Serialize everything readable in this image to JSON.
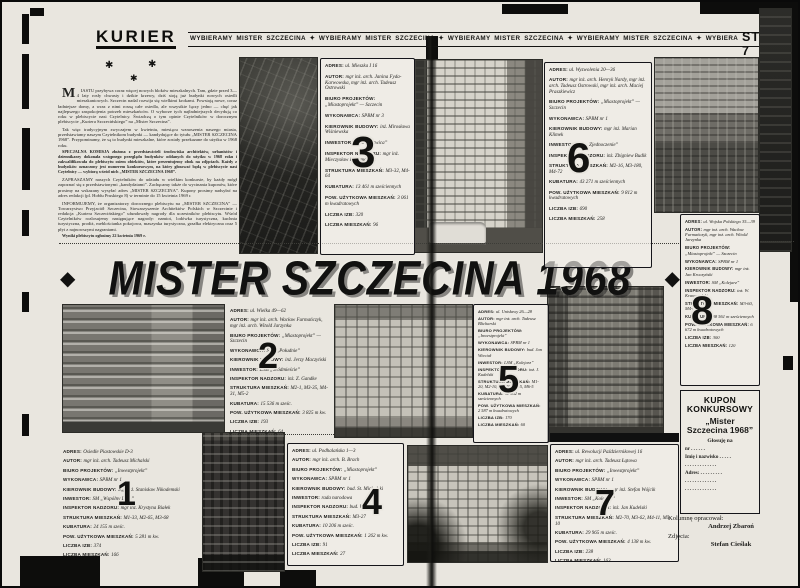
{
  "header": {
    "masthead": "KURIER",
    "slogan": "WYBIERAMY MISTER SZCZECINA ✦ WYBIERAMY MISTER SZCZECINA ✦ WYBIERAMY MISTER SZCZECINA ✦ WYBIERAMY MISTER SZCZECINA ✦ WYBIERAMY MISTER SZCZECINA ✦ WYBIERAMY MISTER",
    "page_number": "STR. 6-7"
  },
  "title": {
    "text": "MISTER SZCZECINA 1968",
    "left_diamond": "◆",
    "right_diamond": "◆"
  },
  "decor": {
    "stars": [
      "✱",
      "✱",
      "✱"
    ]
  },
  "intro": {
    "paragraphs": [
      {
        "drop": "M",
        "bold": false,
        "text": "IASTU przybywa coraz więcej nowych bloków mieszkalnych. Tam, gdzie przed 3—4 laty rosły chwasty i dzikie krzewy, dziś stoją już budynki nowych osiedli mieszkaniowych. Szczecin nadal rozwija się wielkimi krokami. Powstają nowe, coraz ładniejsze domy, a wraz z nimi rosną całe osiedla, ale wszystkie łączy jedno — chęć jak najlepszego zaspokojenia potrzeb mieszkańców. O wyborze tych najładniejszych decydują co roku w plebiscycie nasi Czytelnicy. Świadczą o tym opinie Czytelników w dorocznym plebiscycie „Kuriera Szczecińskiego” na „Mister Szczecina”."
      },
      {
        "bold": false,
        "text": "Tak więc tradycyjnym zwyczajem w kwietniu, miesiącu wznoszenia naszego miasta, przedstawiamy naszym Czytelnikom budynki — kandydujące do tytułu „MISTER SZCZECINA 1968”. Przypominamy, że są to budynki mieszkalne, które zostały przekazane do użytku w 1968 roku."
      },
      {
        "bold": true,
        "text": "SPECJALNA KOMISJA złożona z przedstawicieli środowiska architektów, urbanistów i dziennikarzy dokonała wstępnego przeglądu budynków oddanych do użytku w 1968 roku i zakwalifikowała do plebiscytu osiem obiektów, które prezentujemy obok na zdjęciach. Każdy z budynków oznaczony jest numerem konkursowym, na który głosować będą w plebiscycie nasi Czytelnicy — wybiorą wśród nich „MISTER SZCZECINA 1968”."
      },
      {
        "bold": false,
        "text": "ZAPRASZAMY naszych Czytelników do udziału w wielkim konkursie, by każdy mógł zapoznać się z przedstawionymi „kandydatami”. Zachęcamy także do wycinania kuponów, które prosimy na wskazany wysyłać adres „MISTER SZCZECINA”. Kupony prosimy nadsyłać na adres redakcji (pl. Hołdu Pruskiego 8) w terminie do 15 kwietnia 1969 r."
      },
      {
        "bold": false,
        "text": "INFORMUJEMY, że organizatorzy dorocznego plebiscytu na „MISTER SZCZECINA” — Towarzystwo Przyjaciół Szczecina, Stowarzyszenie Architektów Polskich w Szczecinie i redakcja „Kuriera Szczecińskiego” ufundowały nagrody dla uczestników plebiscytu. Wśród Czytelników rozlosujemy następujące nagrody: namiot, lodówka turystyczna, kuchnia turystyczna, prodiż, meblościanka pokojowa, maszynka turystyczna, grzałka elektryczna oraz 5 płyt z najnowszymi nagraniami."
      },
      {
        "bold": true,
        "text": "Wyniki plebiscytu ogłosimy 22 kwietnia 1969 r."
      }
    ]
  },
  "blocks": [
    {
      "number": "1",
      "lines": [
        {
          "label": "ADRES:",
          "text": "Osiedle Piastowskie D-3"
        },
        {
          "label": "AUTOR:",
          "text": "mgr inż. arch. Tadeusz Michalski"
        },
        {
          "label": "BIURO PROJEKTÓW:",
          "text": "„Inwestprojekt”"
        },
        {
          "label": "WYKONAWCA:",
          "text": "SPBM nr 1"
        },
        {
          "label": "KIEROWNIK BUDOWY:",
          "text": "mgr inż. Stanisław Nikodemski"
        },
        {
          "label": "INWESTOR:",
          "text": "SM „Wspólny Dom”"
        },
        {
          "label": "INSPEKTOR NADZORU:",
          "text": "mgr inż. Krystyna Białek"
        },
        {
          "label": "STRUKTURA MIESZKAŃ:",
          "text": "M1-33, M2-65, M3-68"
        },
        {
          "label": "KUBATURA:",
          "text": "24 155 m sześc."
        },
        {
          "label": "POW. UŻYTKOWA MIESZKAŃ:",
          "text": "5 281 m kw."
        },
        {
          "label": "LICZBA IZB:",
          "text": "374"
        },
        {
          "label": "LICZBA MIESZKAŃ:",
          "text": "166"
        }
      ]
    },
    {
      "number": "2",
      "lines": [
        {
          "label": "ADRES:",
          "text": "ul. Wielka 49—62"
        },
        {
          "label": "AUTOR:",
          "text": "mgr inż. arch. Wacław Furmańczyk, mgr inż. arch. Witold Jarzynka"
        },
        {
          "label": "BIURO PROJEKTÓW:",
          "text": "„Miastoprojekt” — Szczecin"
        },
        {
          "label": "WYKONAWCA:",
          "text": "SPB „Południe”"
        },
        {
          "label": "KIEROWNIK BUDOWY:",
          "text": "inż. Jerzy Maczyński"
        },
        {
          "label": "INWESTOR:",
          "text": "LSM „Śródmieście”"
        },
        {
          "label": "INSPEKTOR NADZORU:",
          "text": "inż. Z. Gandke"
        },
        {
          "label": "STRUKTURA MIESZKAŃ:",
          "text": "M2-1, M3-35, M4-31, M5-2"
        },
        {
          "label": "KUBATURA:",
          "text": "15 536 m sześc."
        },
        {
          "label": "POW. UŻYTKOWA MIESZKAŃ:",
          "text": "3 825 m kw."
        },
        {
          "label": "LICZBA IZB:",
          "text": "193"
        },
        {
          "label": "LICZBA MIESZKAŃ:",
          "text": "64"
        }
      ]
    },
    {
      "number": "3",
      "lines": [
        {
          "label": "ADRES:",
          "text": "ul. Mieszka I 16"
        },
        {
          "label": "AUTOR:",
          "text": "mgr inż. arch. Janina Fyda-Karwowska, mgr inż. arch. Tadeusz Ostrowski"
        },
        {
          "label": "BIURO PROJEKTÓW:",
          "text": "„Miastoprojekt” — Szczecin"
        },
        {
          "label": "WYKONAWCA:",
          "text": "SPBM nr 3"
        },
        {
          "label": "KIEROWNIK BUDOWY:",
          "text": "inż. Mirosława Wiśniewska"
        },
        {
          "label": "INWESTOR:",
          "text": "LSM „Kotwica”"
        },
        {
          "label": "INSPEKTOR NADZORU:",
          "text": "mgr inż. Mieczysław Bajtamowicz"
        },
        {
          "label": "STRUKTURA MIESZKAŃ:",
          "text": "M3-32, M4-64"
        },
        {
          "label": "KUBATURA:",
          "text": "13 461 m sześciennych"
        },
        {
          "label": "POW. UŻYTKOWA MIESZKAŃ:",
          "text": "3 061 m kwadratowych"
        },
        {
          "label": "LICZBA IZB:",
          "text": "320"
        },
        {
          "label": "LICZBA MIESZKAŃ:",
          "text": "96"
        }
      ]
    },
    {
      "number": "4",
      "lines": [
        {
          "label": "ADRES:",
          "text": "ul. Podhalańska 1—3"
        },
        {
          "label": "AUTOR:",
          "text": "mgr inż. arch. B. Brach"
        },
        {
          "label": "BIURO PROJEKTÓW:",
          "text": "„Miastoprojekt”"
        },
        {
          "label": "WYKONAWCA:",
          "text": "SPBM nr 1"
        },
        {
          "label": "KIEROWNIK BUDOWY:",
          "text": "bud. St. Michalski"
        },
        {
          "label": "INWESTOR:",
          "text": "rada narodowa"
        },
        {
          "label": "INSPEKTOR NADZORU:",
          "text": "bud. W. Kret"
        },
        {
          "label": "STRUKTURA MIESZKAŃ:",
          "text": "M3-27"
        },
        {
          "label": "KUBATURA:",
          "text": "10 206 m sześc."
        },
        {
          "label": "POW. UŻYTKOWA MIESZKAŃ:",
          "text": "1 262 m kw."
        },
        {
          "label": "LICZBA IZB:",
          "text": "91"
        },
        {
          "label": "LICZBA MIESZKAŃ:",
          "text": "27"
        }
      ]
    },
    {
      "number": "5",
      "lines": [
        {
          "label": "ADRES:",
          "text": "ul. Unisławy 26—28"
        },
        {
          "label": "AUTOR:",
          "text": "mgr inż. arch. Tadeusz Blicharski"
        },
        {
          "label": "BIURO PROJEKTÓW:",
          "text": "„Inwestprojekt”"
        },
        {
          "label": "WYKONAWCA:",
          "text": "SPBM nr 1"
        },
        {
          "label": "KIEROWNIK BUDOWY:",
          "text": "bud. Jan Wieciał"
        },
        {
          "label": "INWESTOR:",
          "text": "LSM „Kolejarz”"
        },
        {
          "label": "INSPEKTOR NADZORU:",
          "text": "inż. J. Kudelski"
        },
        {
          "label": "STRUKTURA MIESZKAŃ:",
          "text": "M1-20, M2-10, M4-20, M5-5, M6-5"
        },
        {
          "label": "KUBATURA:",
          "text": "11 962 m sześciennych"
        },
        {
          "label": "POW. UŻYTKOWA MIESZKAŃ:",
          "text": "2 587 m kwadratowych"
        },
        {
          "label": "LICZBA IZB:",
          "text": "170"
        },
        {
          "label": "LICZBA MIESZKAŃ:",
          "text": "60"
        }
      ]
    },
    {
      "number": "6",
      "lines": [
        {
          "label": "ADRES:",
          "text": "ul. Wyzwolenia 20—36"
        },
        {
          "label": "AUTOR:",
          "text": "mgr inż. arch. Henryk Nardy, mgr inż. arch. Tadeusz Ostrowski, mgr inż. arch. Maciej Praszkiewicz"
        },
        {
          "label": "BIURO PROJEKTÓW:",
          "text": "„Miastoprojekt” — Szczecin"
        },
        {
          "label": "WYKONAWCA:",
          "text": "SPBM nr 1"
        },
        {
          "label": "KIEROWNIK BUDOWY:",
          "text": "mgr inż. Marian Klimek"
        },
        {
          "label": "INWESTOR:",
          "text": "SM „Zjednoczenie”"
        },
        {
          "label": "INSPEKTOR NADZORU:",
          "text": "inż. Zbigniew Budik"
        },
        {
          "label": "STRUKTURA MIESZKAŃ:",
          "text": "M2-16, M3-180, M4-72"
        },
        {
          "label": "KUBATURA:",
          "text": "43 271 m sześciennych"
        },
        {
          "label": "POW. UŻYTKOWA MIESZKAŃ:",
          "text": "9 812 m kwadratowych"
        },
        {
          "label": "LICZBA IZB:",
          "text": "690"
        },
        {
          "label": "LICZBA MIESZKAŃ:",
          "text": "258"
        }
      ]
    },
    {
      "number": "7",
      "lines": [
        {
          "label": "ADRES:",
          "text": "ul. Rewolucji Październikowej 16"
        },
        {
          "label": "AUTOR:",
          "text": "mgr inż. arch. Tadeusz Łątowa"
        },
        {
          "label": "BIURO PROJEKTÓW:",
          "text": "„Inwestprojekt”"
        },
        {
          "label": "WYKONAWCA:",
          "text": "SPBM nr 1"
        },
        {
          "label": "KIEROWNIK BUDOWY:",
          "text": "mgr inż. Stefan Wójcik"
        },
        {
          "label": "INWESTOR:",
          "text": "SM „Kolejarz”"
        },
        {
          "label": "INSPEKTOR NADZORU:",
          "text": "inż. Jan Kudelski"
        },
        {
          "label": "STRUKTURA MIESZKAŃ:",
          "text": "M2-70, M3-62, M4-11, M5-10"
        },
        {
          "label": "KUBATURA:",
          "text": "29 965 m sześc."
        },
        {
          "label": "POW. UŻYTKOWA MIESZKAŃ:",
          "text": "4 138 m kw."
        },
        {
          "label": "LICZBA IZB:",
          "text": "238"
        },
        {
          "label": "LICZBA MIESZKAŃ:",
          "text": "163"
        }
      ]
    },
    {
      "number": "8",
      "lines": [
        {
          "label": "ADRES:",
          "text": "ul. Wojska Polskiego 35—39"
        },
        {
          "label": "AUTOR:",
          "text": "mgr inż. arch. Wacław Furmańczyk, mgr inż. arch. Witold Jarzynka"
        },
        {
          "label": "BIURO PROJEKTÓW:",
          "text": "„Miastoprojekt” — Szczecin"
        },
        {
          "label": "WYKONAWCA:",
          "text": "SPBM nr 1"
        },
        {
          "label": "KIEROWNIK BUDOWY:",
          "text": "mgr inż. Jan Kroczyński"
        },
        {
          "label": "INWESTOR:",
          "text": "SM „Kolejarz”"
        },
        {
          "label": "INSPEKTOR NADZORU:",
          "text": "inż. W. Krawczyński"
        },
        {
          "label": "STRUKTURA MIESZKAŃ:",
          "text": "M3-60, M4-60"
        },
        {
          "label": "KUBATURA:",
          "text": "38 561 m sześciennych"
        },
        {
          "label": "POW. UŻYTKOWA MIESZKAŃ:",
          "text": "6 672 m kwadratowych"
        },
        {
          "label": "LICZBA IZB:",
          "text": "300"
        },
        {
          "label": "LICZBA MIESZKAŃ:",
          "text": "120"
        }
      ]
    }
  ],
  "kupon": {
    "title": "KUPON KONKURSOWY",
    "subtitle": "„Mister Szczecina 1968”",
    "vote": "Głosuję na",
    "nr": "nr . . . . . .",
    "name": "Imię i nazwisko . . . . .",
    "dots1": ". . . . . . . . . . . . .",
    "adres": "Adres: . . . . . . . . .",
    "dots2": ". . . . . . . . . . . . .",
    "dots3": ". . . . . . . . . . . . ."
  },
  "credits": {
    "column_label": "Kolumnę opracował:",
    "column_name": "Andrzej Zbaroń",
    "photo_label": "Zdjęcia:",
    "photo_name": "Stefan Cieślak"
  }
}
